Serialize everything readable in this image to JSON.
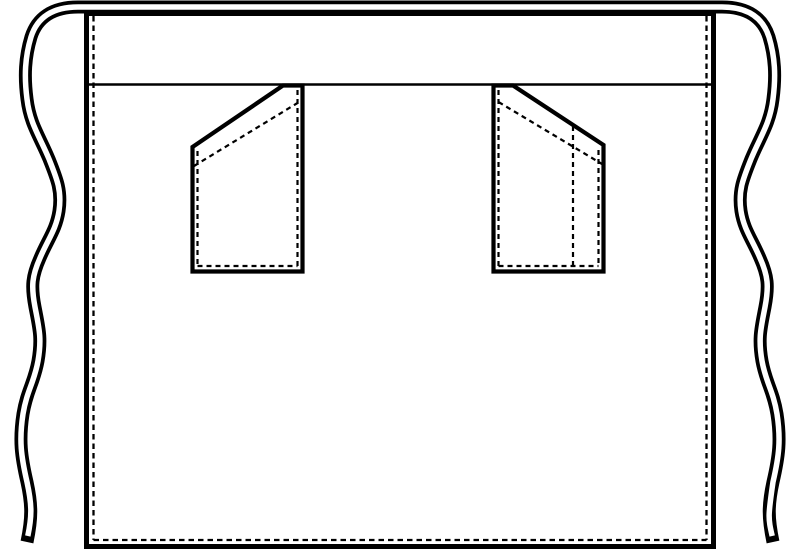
{
  "figure": {
    "kind": "technical-flat-sketch",
    "subject": "half-waist-apron-front-view",
    "colors": {
      "line": "#000000",
      "paper": "#ffffff"
    },
    "parts": {
      "ties": "waist-tie-ribbon-double-line-wavy-both-sides",
      "body": "apron-body-rectangle-solid-outline",
      "waistband_seam": "horizontal-waistband-seam-line",
      "hem_stitching": "inner-dashed-stitch-lines-left-right-bottom",
      "left_pocket": "slant-top-patch-pocket-high-corner-inward",
      "right_pocket": "slant-top-patch-pocket-high-corner-inward-with-pen-divider",
      "pen_divider": "vertical-dashed-divider-stitch"
    }
  }
}
